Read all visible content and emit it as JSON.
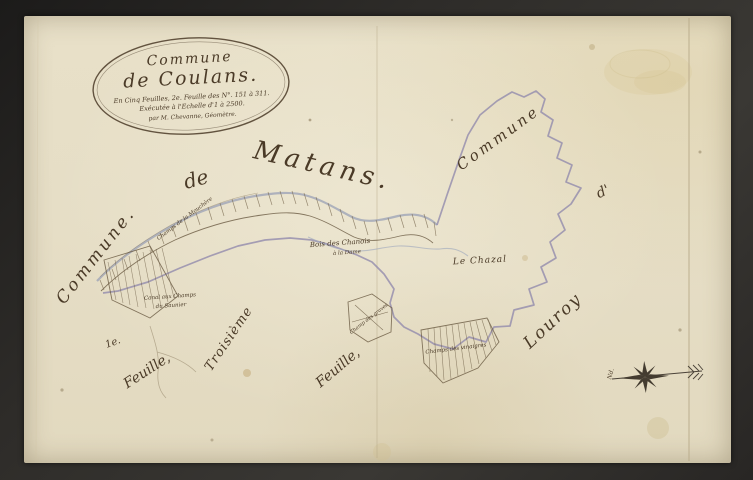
{
  "cartouche": {
    "line1": "Commune",
    "line2": "de Coulans.",
    "line3": "En Cinq Feuilles, 2e. Feuille des N°. 151 à 311.",
    "line4": "Exécutée à l'Echelle d'1 à 2500.",
    "line5": "par M. Chevanne, Géomètre."
  },
  "labels": {
    "commune_left": "Commune.",
    "de_word": "de",
    "matans": "Matans.",
    "commune_top_right": "Commune",
    "d_apostrophe": "d'",
    "louroy": "Louroy",
    "feuille1_num": "1e.",
    "feuille1_word": "Feuille,",
    "troisieme": "Troisième",
    "feuille3_word": "Feuille,",
    "mouchere": "Champs de la Mouchère",
    "bois_chanois_line1": "Bois des Chanois",
    "bois_chanois_line2": "à la Dame",
    "le_chazal": "Le Chazal",
    "canal_line1": "Canal aux Champs",
    "canal_line2": "du Saunier",
    "champ_graves": "Champ des graves",
    "champs_vinaigres": "Champs des vinaigres",
    "north_abbr": "Nd."
  },
  "colors": {
    "paper": "#e6dec6",
    "ink": "#4a3a27",
    "boundary_line": "#928bac",
    "stream": "#a2abbd",
    "frame": "#2e2c29",
    "stain": "#d6c48e"
  }
}
